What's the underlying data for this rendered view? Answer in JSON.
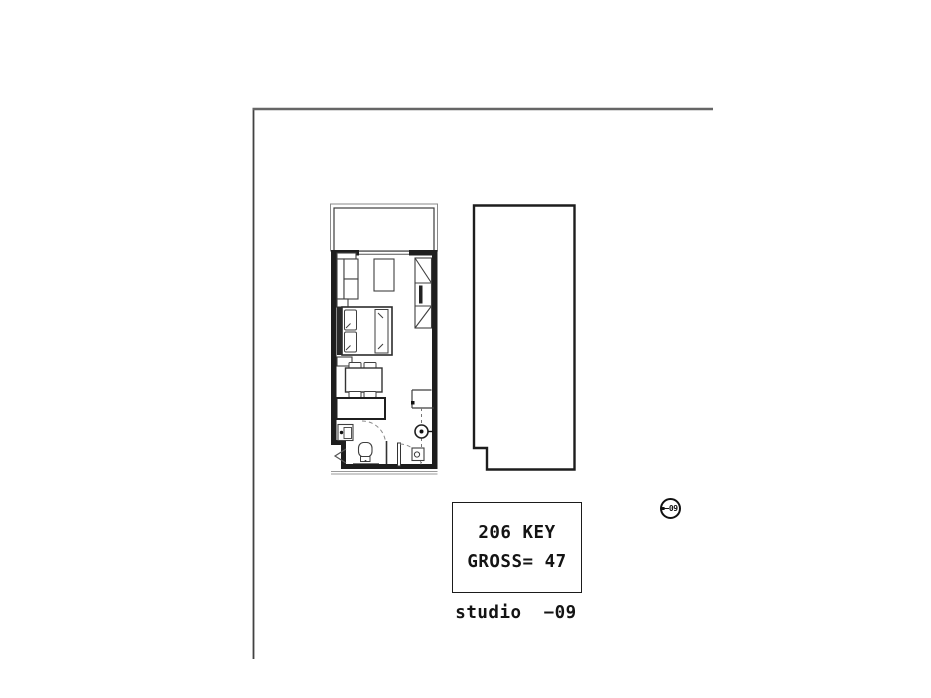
{
  "sheet": {
    "background": "#ffffff",
    "border_color_vertical": "#424242",
    "border_color_horizontal": "#666666"
  },
  "plan": {
    "wall_color": "#1d1d1d",
    "furniture_line_color": "#3f3f3f",
    "door_swing_color": "#8a8a8a"
  },
  "key_box": {
    "line1": "206 KEY",
    "line2": "GROSS= 47"
  },
  "caption": "studio  −09",
  "marker": {
    "text": "09"
  },
  "text_color": "#141414"
}
